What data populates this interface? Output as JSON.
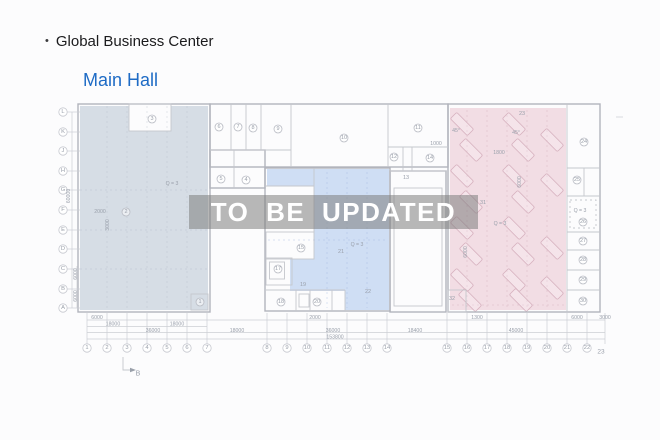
{
  "header": {
    "bullet": "•",
    "title": "Global Business Center",
    "subtitle": "Main Hall"
  },
  "watermark": {
    "text": "TO BE UPDATED"
  },
  "plan": {
    "colors": {
      "left_zone": "#d3dae3",
      "middle_zone": "#ccdcf3",
      "right_zone": "#f1dbe3"
    },
    "grid_rows": [
      {
        "t": "L",
        "x": 63,
        "y": 112
      },
      {
        "t": "K",
        "x": 63,
        "y": 132
      },
      {
        "t": "J",
        "x": 63,
        "y": 151
      },
      {
        "t": "H",
        "x": 63,
        "y": 171
      },
      {
        "t": "G",
        "x": 63,
        "y": 190
      },
      {
        "t": "F",
        "x": 63,
        "y": 210
      },
      {
        "t": "E",
        "x": 63,
        "y": 230
      },
      {
        "t": "D",
        "x": 63,
        "y": 249
      },
      {
        "t": "C",
        "x": 63,
        "y": 269
      },
      {
        "t": "B",
        "x": 63,
        "y": 289
      },
      {
        "t": "A",
        "x": 63,
        "y": 308
      }
    ],
    "grid_cols": [
      {
        "t": "1",
        "x": 87,
        "y": 348
      },
      {
        "t": "2",
        "x": 107,
        "y": 348
      },
      {
        "t": "3",
        "x": 127,
        "y": 348
      },
      {
        "t": "4",
        "x": 147,
        "y": 348
      },
      {
        "t": "5",
        "x": 167,
        "y": 348
      },
      {
        "t": "6",
        "x": 187,
        "y": 348
      },
      {
        "t": "7",
        "x": 207,
        "y": 348
      },
      {
        "t": "8",
        "x": 267,
        "y": 348
      },
      {
        "t": "9",
        "x": 287,
        "y": 348
      },
      {
        "t": "10",
        "x": 307,
        "y": 348
      },
      {
        "t": "11",
        "x": 327,
        "y": 348
      },
      {
        "t": "12",
        "x": 347,
        "y": 348
      },
      {
        "t": "13",
        "x": 367,
        "y": 348
      },
      {
        "t": "14",
        "x": 387,
        "y": 348
      },
      {
        "t": "15",
        "x": 447,
        "y": 348
      },
      {
        "t": "16",
        "x": 467,
        "y": 348
      },
      {
        "t": "17",
        "x": 487,
        "y": 348
      },
      {
        "t": "18",
        "x": 507,
        "y": 348
      },
      {
        "t": "19",
        "x": 527,
        "y": 348
      },
      {
        "t": "20",
        "x": 547,
        "y": 348
      },
      {
        "t": "21",
        "x": 567,
        "y": 348
      },
      {
        "t": "22",
        "x": 587,
        "y": 348
      },
      {
        "t": "23",
        "x": 601,
        "y": 352,
        "circle": false,
        "fs": 6.5
      }
    ],
    "rooms": [
      {
        "t": "1",
        "x": 200,
        "y": 302
      },
      {
        "t": "2",
        "x": 126,
        "y": 212
      },
      {
        "t": "3",
        "x": 152,
        "y": 119
      },
      {
        "t": "4",
        "x": 246,
        "y": 180
      },
      {
        "t": "5",
        "x": 221,
        "y": 179
      },
      {
        "t": "6",
        "x": 219,
        "y": 127
      },
      {
        "t": "7",
        "x": 238,
        "y": 127
      },
      {
        "t": "8",
        "x": 253,
        "y": 128
      },
      {
        "t": "9",
        "x": 278,
        "y": 129
      },
      {
        "t": "10",
        "x": 344,
        "y": 138
      },
      {
        "t": "11",
        "x": 418,
        "y": 128
      },
      {
        "t": "12",
        "x": 394,
        "y": 157
      },
      {
        "t": "13",
        "x": 406,
        "y": 178,
        "circle": false
      },
      {
        "t": "14",
        "x": 430,
        "y": 158
      },
      {
        "t": "15",
        "x": 301,
        "y": 248
      },
      {
        "t": "17",
        "x": 278,
        "y": 269
      },
      {
        "t": "18",
        "x": 281,
        "y": 302
      },
      {
        "t": "19",
        "x": 303,
        "y": 285,
        "circle": false
      },
      {
        "t": "20",
        "x": 317,
        "y": 302
      },
      {
        "t": "21",
        "x": 341,
        "y": 252,
        "circle": false
      },
      {
        "t": "22",
        "x": 368,
        "y": 292,
        "circle": false
      },
      {
        "t": "23",
        "x": 522,
        "y": 114,
        "circle": false
      },
      {
        "t": "24",
        "x": 584,
        "y": 142
      },
      {
        "t": "25",
        "x": 577,
        "y": 180
      },
      {
        "t": "26",
        "x": 583,
        "y": 222
      },
      {
        "t": "27",
        "x": 583,
        "y": 241
      },
      {
        "t": "28",
        "x": 583,
        "y": 260
      },
      {
        "t": "29",
        "x": 583,
        "y": 280
      },
      {
        "t": "30",
        "x": 583,
        "y": 301
      },
      {
        "t": "31",
        "x": 483,
        "y": 203,
        "circle": false
      },
      {
        "t": "32",
        "x": 452,
        "y": 299,
        "circle": false
      }
    ],
    "notes": [
      {
        "t": "2000",
        "x": 100,
        "y": 212
      },
      {
        "t": "3000",
        "x": 108,
        "y": 225,
        "rot": -90
      },
      {
        "t": "Q = 3",
        "x": 172,
        "y": 184
      },
      {
        "t": "Q = 3",
        "x": 357,
        "y": 245
      },
      {
        "t": "1000",
        "x": 436,
        "y": 144
      },
      {
        "t": "1800",
        "x": 499,
        "y": 153
      },
      {
        "t": "45°",
        "x": 456,
        "y": 131
      },
      {
        "t": "45°",
        "x": 516,
        "y": 133
      },
      {
        "t": "6000",
        "x": 520,
        "y": 182,
        "rot": -90
      },
      {
        "t": "6000",
        "x": 466,
        "y": 252,
        "rot": -90
      },
      {
        "t": "Q = 3",
        "x": 500,
        "y": 224
      },
      {
        "t": "Q = 3",
        "x": 580,
        "y": 211
      }
    ],
    "dims": [
      {
        "t": "6000",
        "x": 97,
        "y": 318
      },
      {
        "t": "18000",
        "x": 113,
        "y": 324.5
      },
      {
        "t": "18000",
        "x": 177,
        "y": 324.5
      },
      {
        "t": "36000",
        "x": 153,
        "y": 331
      },
      {
        "t": "18000",
        "x": 237,
        "y": 331
      },
      {
        "t": "2000",
        "x": 315,
        "y": 318
      },
      {
        "t": "36000",
        "x": 333,
        "y": 331
      },
      {
        "t": "18400",
        "x": 415,
        "y": 331
      },
      {
        "t": "153800",
        "x": 335,
        "y": 337.5
      },
      {
        "t": "1300",
        "x": 477,
        "y": 318
      },
      {
        "t": "45000",
        "x": 516,
        "y": 331
      },
      {
        "t": "6000",
        "x": 577,
        "y": 318
      },
      {
        "t": "3000",
        "x": 605,
        "y": 318
      },
      {
        "t": "60000",
        "x": 69,
        "y": 196,
        "rot": -90
      },
      {
        "t": "6000",
        "x": 76,
        "y": 274,
        "rot": -90
      },
      {
        "t": "6000",
        "x": 76,
        "y": 296,
        "rot": -90
      }
    ],
    "section_marker": {
      "t": "B",
      "x": 138,
      "y": 374
    },
    "parking": [
      {
        "x": 462,
        "y": 124,
        "r": -45
      },
      {
        "x": 471,
        "y": 150,
        "r": -45
      },
      {
        "x": 462,
        "y": 176,
        "r": -45
      },
      {
        "x": 471,
        "y": 202,
        "r": -45
      },
      {
        "x": 462,
        "y": 228,
        "r": -45
      },
      {
        "x": 471,
        "y": 254,
        "r": -45
      },
      {
        "x": 462,
        "y": 280,
        "r": -45
      },
      {
        "x": 470,
        "y": 300,
        "r": -45
      },
      {
        "x": 514,
        "y": 124,
        "r": -45
      },
      {
        "x": 523,
        "y": 150,
        "r": -45
      },
      {
        "x": 514,
        "y": 176,
        "r": -45
      },
      {
        "x": 523,
        "y": 202,
        "r": -45
      },
      {
        "x": 514,
        "y": 228,
        "r": -45
      },
      {
        "x": 523,
        "y": 254,
        "r": -45
      },
      {
        "x": 514,
        "y": 280,
        "r": -45
      },
      {
        "x": 521,
        "y": 300,
        "r": -45
      },
      {
        "x": 552,
        "y": 140,
        "r": -45
      },
      {
        "x": 552,
        "y": 185,
        "r": -45
      },
      {
        "x": 552,
        "y": 248,
        "r": -45
      },
      {
        "x": 552,
        "y": 288,
        "r": -45
      }
    ]
  }
}
